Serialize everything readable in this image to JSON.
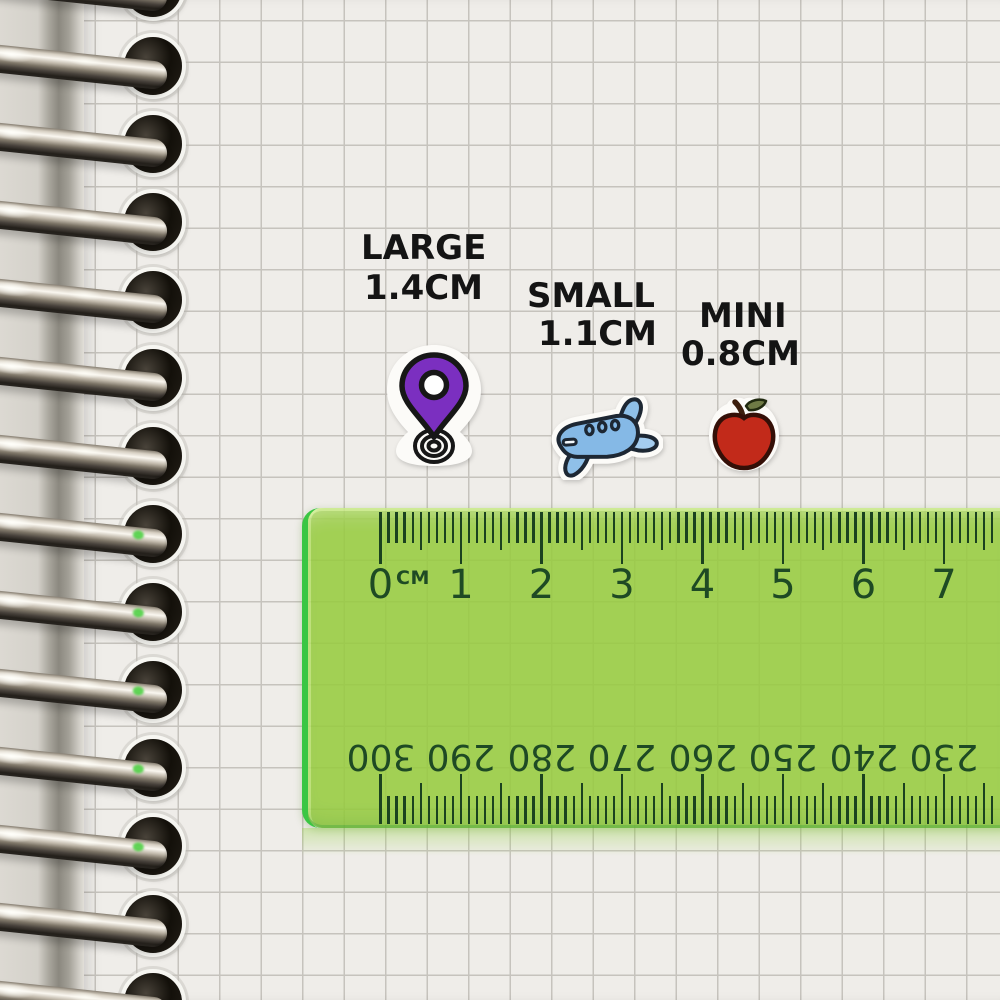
{
  "labels": {
    "large": {
      "name": "LARGE",
      "size": "1.4CM"
    },
    "small": {
      "name": "SMALL",
      "size": "1.1CM"
    },
    "mini": {
      "name": "MINI",
      "size": "0.8CM"
    }
  },
  "ruler": {
    "unit_label": "CM",
    "top_scale_numbers": [
      "0",
      "1",
      "2",
      "3",
      "4",
      "5",
      "6",
      "7"
    ],
    "bottom_scale_numbers": [
      "300",
      "290",
      "280",
      "270",
      "260",
      "250",
      "240",
      "230"
    ],
    "colors": {
      "body_green": "#97cc3f",
      "edge_green": "#3ac643",
      "marking_dark_green": "#1e4a24"
    }
  },
  "stickers": [
    {
      "id": "location-pin-sticker",
      "color": "#7b2fc0"
    },
    {
      "id": "airplane-sticker",
      "color": "#85b9e6"
    },
    {
      "id": "apple-sticker",
      "color": "#c22a1a"
    }
  ],
  "notebook": {
    "ring_count": 14,
    "paper_color": "#efede9",
    "grid_line_color": "#c6c3bd",
    "ring_metal_color": "#d6cfc2"
  }
}
